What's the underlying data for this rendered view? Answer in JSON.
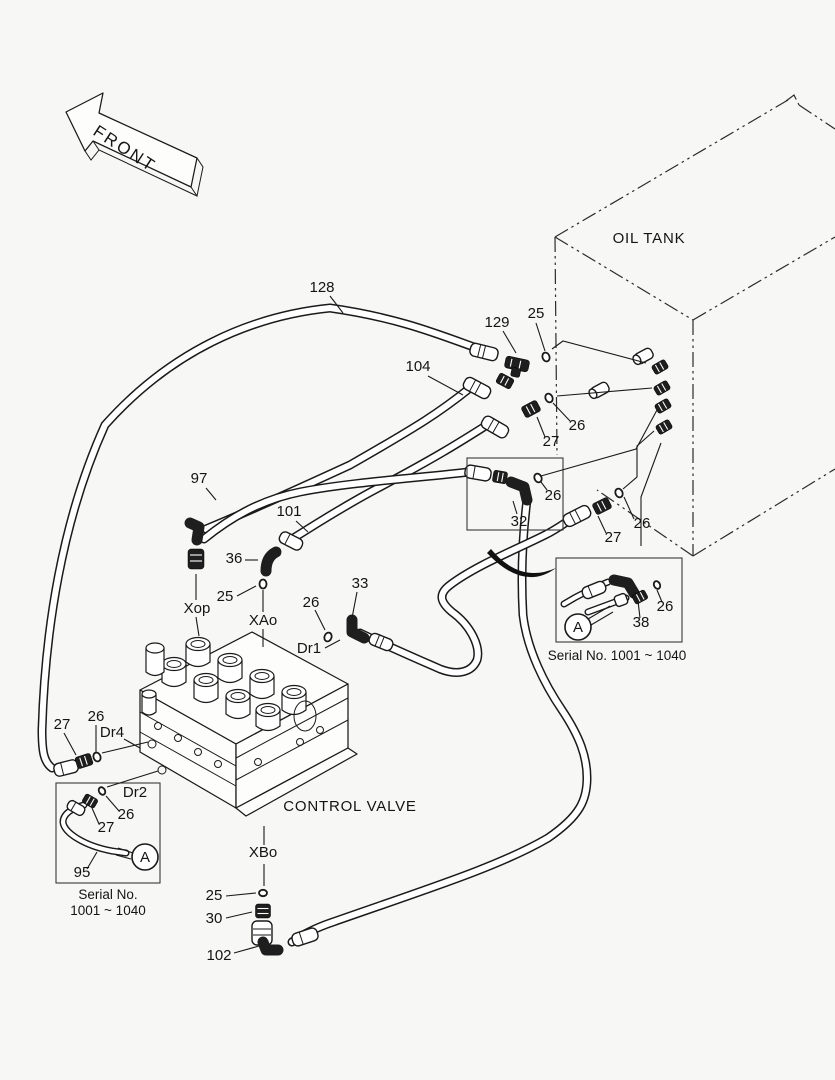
{
  "front_arrow": {
    "label": "FRONT"
  },
  "tank": {
    "label": "OIL TANK"
  },
  "valve": {
    "label": "CONTROL VALVE"
  },
  "detail_right": {
    "marker": "A",
    "serial": "Serial No. 1001 ~ 1040"
  },
  "detail_left": {
    "marker": "A",
    "serial_line1": "Serial No.",
    "serial_line2": "1001 ~ 1040"
  },
  "callouts": [
    {
      "t": "128"
    },
    {
      "t": "129"
    },
    {
      "t": "25"
    },
    {
      "t": "104"
    },
    {
      "t": "26"
    },
    {
      "t": "27"
    },
    {
      "t": "97"
    },
    {
      "t": "101"
    },
    {
      "t": "36"
    },
    {
      "t": "25"
    },
    {
      "t": "Xop"
    },
    {
      "t": "XAo"
    },
    {
      "t": "26"
    },
    {
      "t": "33"
    },
    {
      "t": "Dr1"
    },
    {
      "t": "26"
    },
    {
      "t": "32"
    },
    {
      "t": "27"
    },
    {
      "t": "26"
    },
    {
      "t": "26"
    },
    {
      "t": "38"
    },
    {
      "t": "27"
    },
    {
      "t": "26"
    },
    {
      "t": "Dr4"
    },
    {
      "t": "Dr2"
    },
    {
      "t": "26"
    },
    {
      "t": "27"
    },
    {
      "t": "95"
    },
    {
      "t": "XBo"
    },
    {
      "t": "25"
    },
    {
      "t": "30"
    },
    {
      "t": "102"
    }
  ]
}
